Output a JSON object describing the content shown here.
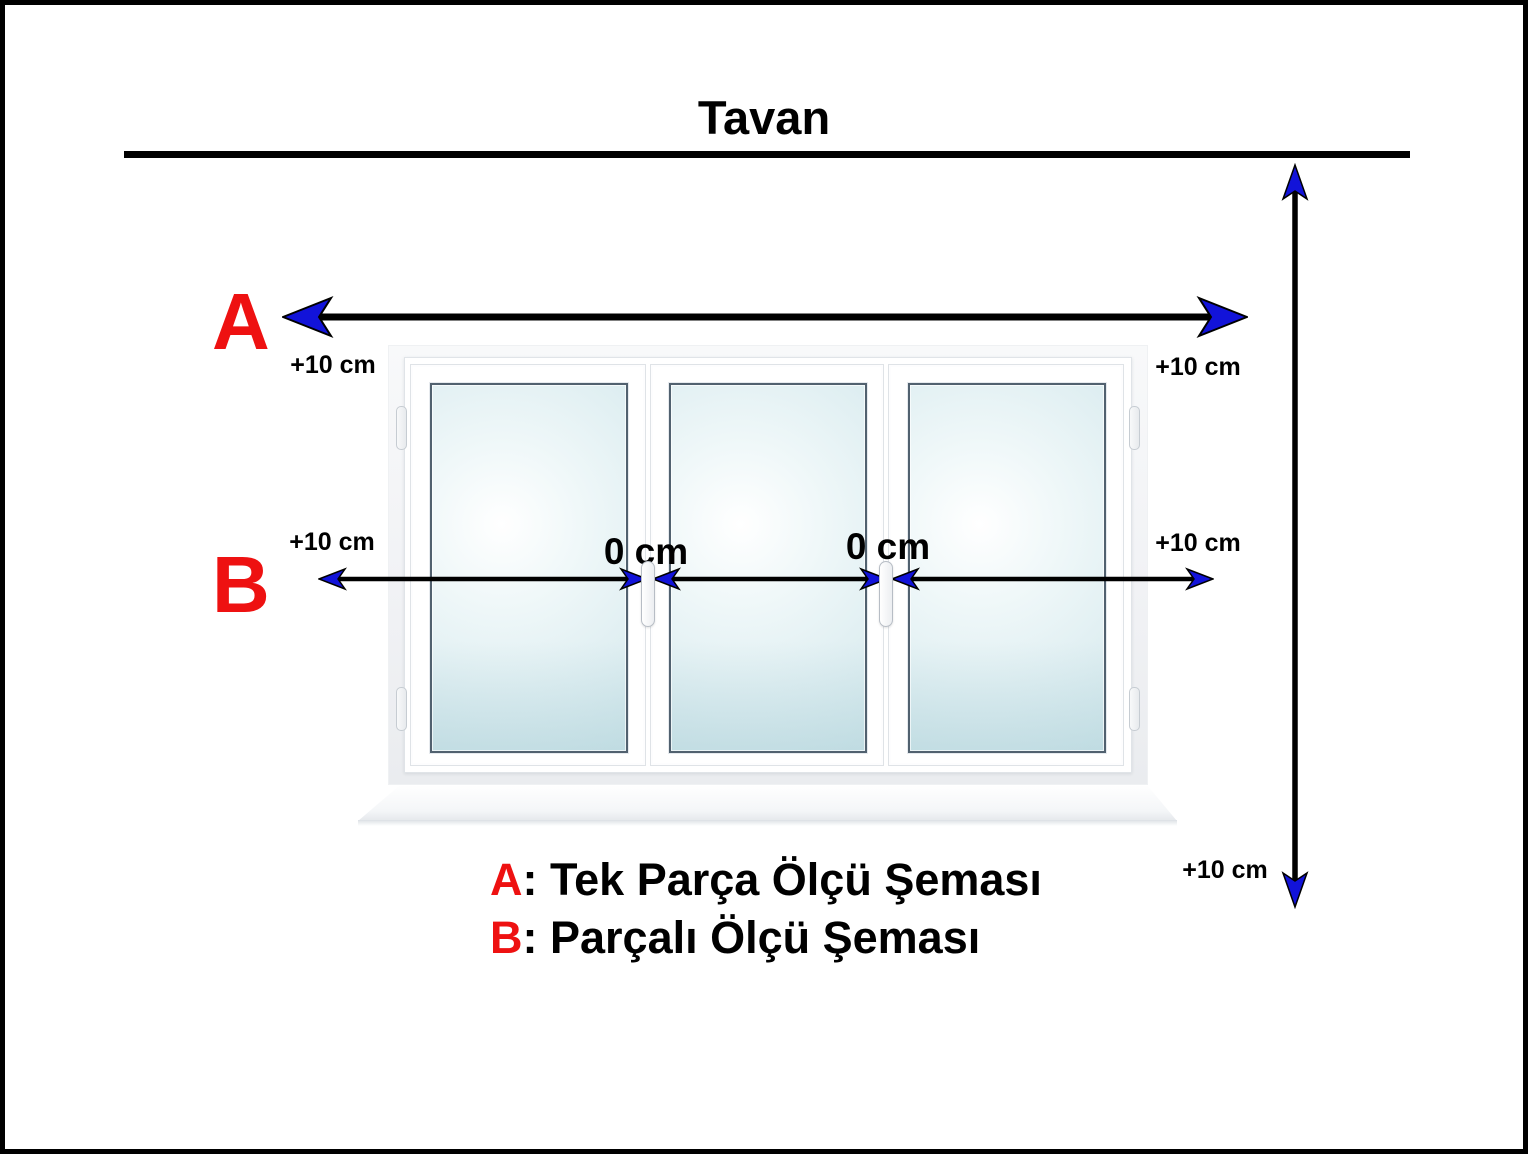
{
  "title": "Tavan",
  "colors": {
    "red": "#ee1111",
    "arrow_blue": "#1213d9",
    "black": "#000000"
  },
  "scheme_a": {
    "letter": "A",
    "left_label": "+10 cm",
    "right_label": "+10 cm"
  },
  "scheme_b": {
    "letter": "B",
    "left_label": "+10 cm",
    "joint1_label": "0 cm",
    "joint2_label": "0 cm",
    "right_label": "+10 cm"
  },
  "height_measure": {
    "bottom_label": "+10 cm"
  },
  "legend": {
    "items": [
      {
        "letter": "A",
        "text": ": Tek Parça Ölçü Şeması"
      },
      {
        "letter": "B",
        "text": ": Parçalı Ölçü Şeması"
      }
    ]
  },
  "window": {
    "icon": "three-pane-window-illustration",
    "pane_count": 3
  }
}
